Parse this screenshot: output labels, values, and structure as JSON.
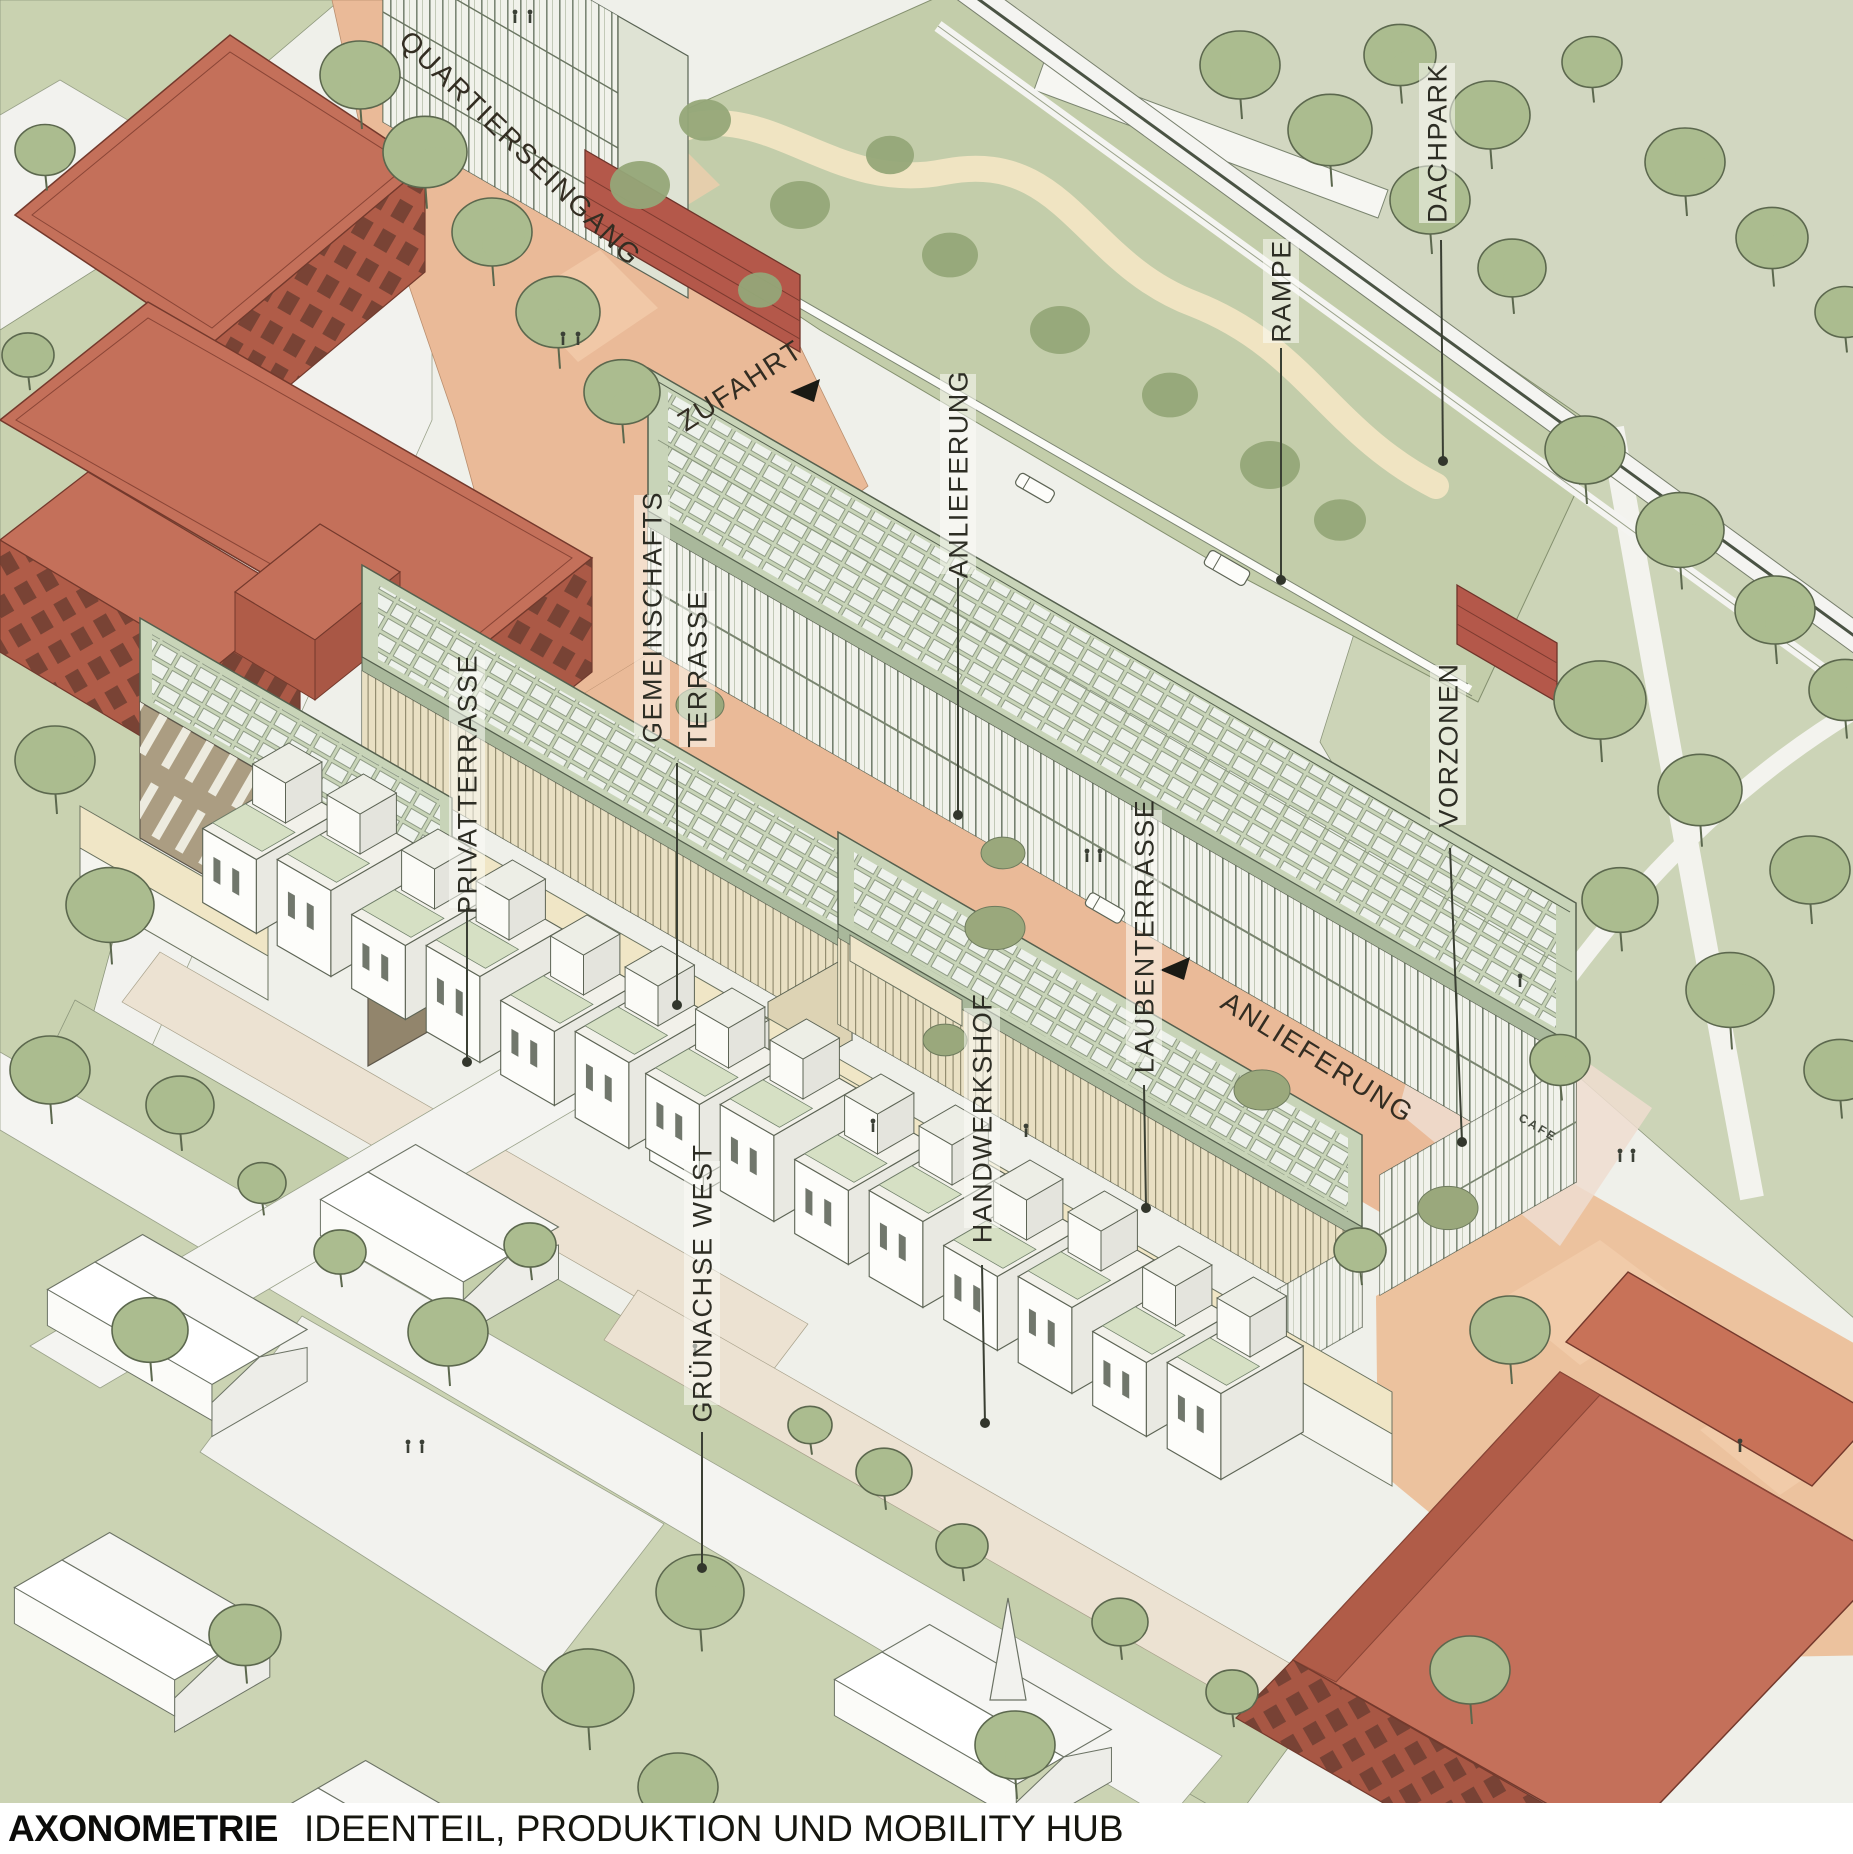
{
  "drawing": {
    "annotations": {
      "quartierseingang": "QUARTIERSEINGANG",
      "zufahrt": "ZUFAHRT",
      "dachpark": "DACHPARK",
      "rampe": "RAMPE",
      "anlieferung_top": "ANLIEFERUNG",
      "gemeinschafts_line1": "GEMEINSCHAFTS",
      "gemeinschafts_line2": "TERRASSE",
      "privatterrasse": "PRIVATTERRASSE",
      "vorzonen": "VORZONEN",
      "laubenterrasse": "LAUBENTERRASSE",
      "anlieferung_street": "ANLIEFERUNG",
      "handwerkshof": "HANDWERKSHOF",
      "gruenachse_west": "GRÜNACHSE WEST",
      "cafe_sign": "CAFE"
    },
    "caption": {
      "title": "AXONOMETRIE",
      "subtitle": "IDEENTEIL, PRODUKTION UND MOBILITY HUB"
    },
    "colors": {
      "paper": "#eff0ea",
      "lawn": "#c9d2b0",
      "plaza_salmon": "#eaba98",
      "roof_sage": "#c8d4b8",
      "solar_panel": "#eef2ec",
      "facade_cream": "#e9e0c3",
      "red_building": "#c4705a",
      "deck_green": "#c3cdaa",
      "tree_green": "#abbc8f",
      "label_ink": "#2d2d24"
    }
  }
}
